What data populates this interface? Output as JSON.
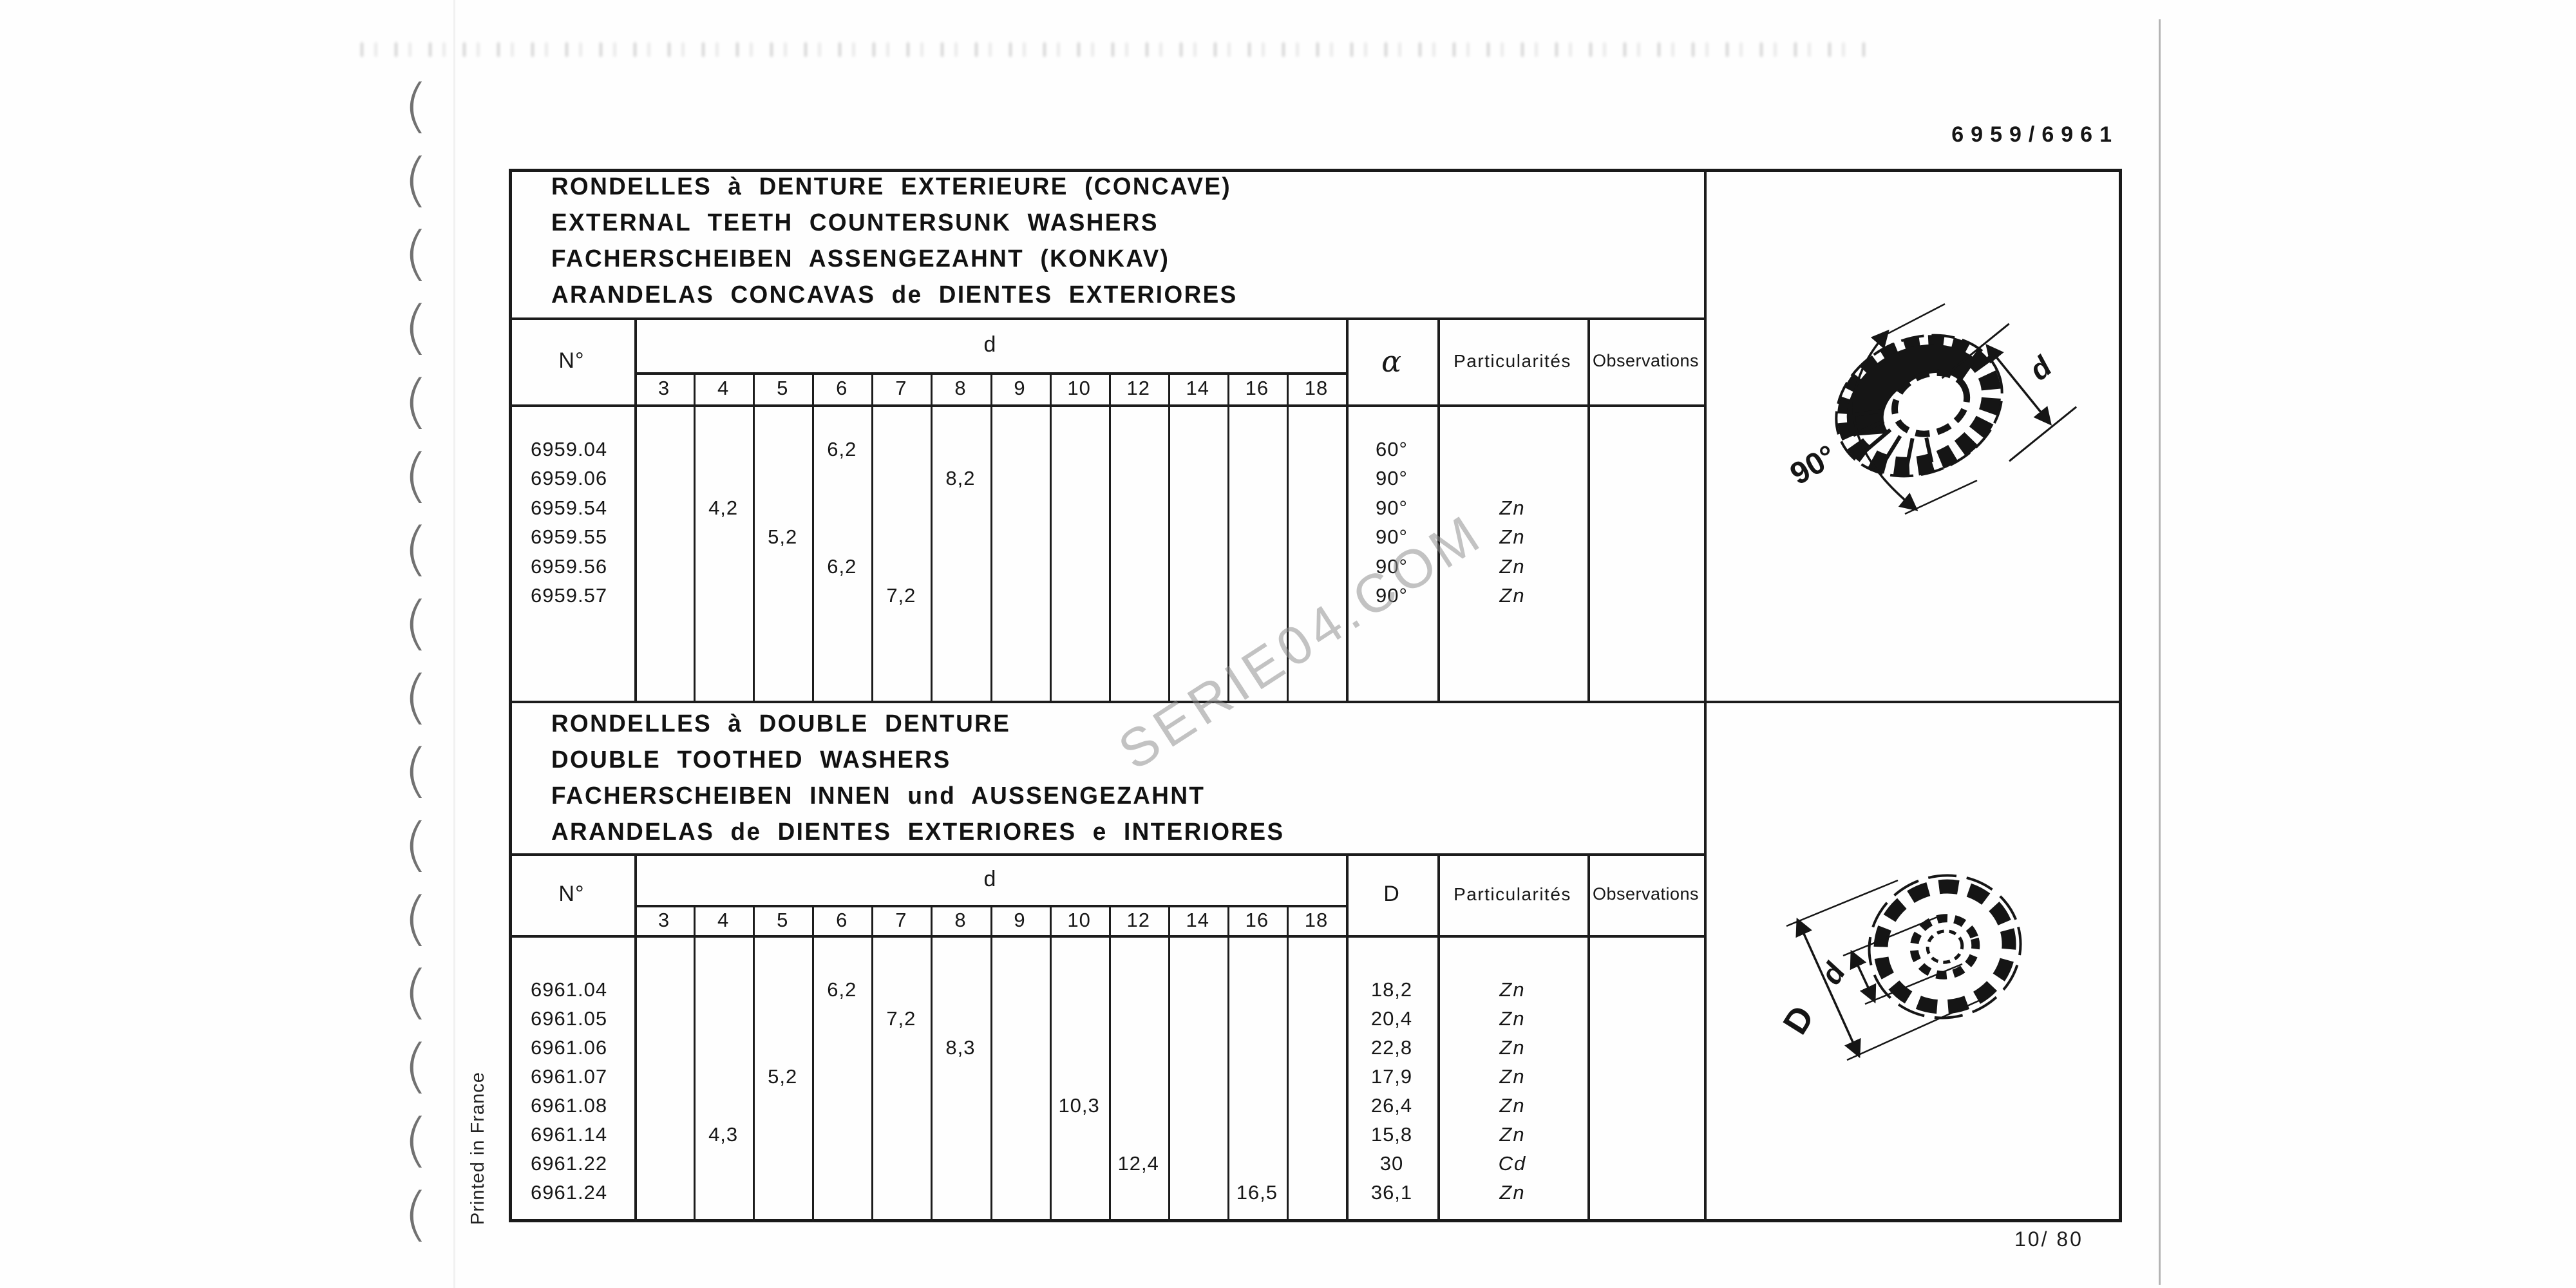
{
  "page": {
    "catalog_ref": "6959/6961",
    "page_number": "10/ 80",
    "printed_in": "Printed in France",
    "watermark": "SERIE04.COM"
  },
  "d_sizes": [
    "3",
    "4",
    "5",
    "6",
    "7",
    "8",
    "9",
    "10",
    "12",
    "14",
    "16",
    "18"
  ],
  "table1": {
    "titles": [
      "RONDELLES à DENTURE EXTERIEURE (CONCAVE)",
      "EXTERNAL TEETH COUNTERSUNK WASHERS",
      "FACHERSCHEIBEN ASSENGEZAHNT (KONKAV)",
      "ARANDELAS CONCAVAS de DIENTES EXTERIORES"
    ],
    "headers": {
      "no": "N°",
      "d": "d",
      "angle": "α",
      "part": "Particularités",
      "obs": "Observations"
    },
    "rows": [
      {
        "no": "6959.04",
        "d_col": "6",
        "d_val": "6,2",
        "angle": "60°",
        "part": ""
      },
      {
        "no": "6959.06",
        "d_col": "8",
        "d_val": "8,2",
        "angle": "90°",
        "part": ""
      },
      {
        "no": "6959.54",
        "d_col": "4",
        "d_val": "4,2",
        "angle": "90°",
        "part": "Zn"
      },
      {
        "no": "6959.55",
        "d_col": "5",
        "d_val": "5,2",
        "angle": "90°",
        "part": "Zn"
      },
      {
        "no": "6959.56",
        "d_col": "6",
        "d_val": "6,2",
        "angle": "90°",
        "part": "Zn"
      },
      {
        "no": "6959.57",
        "d_col": "7",
        "d_val": "7,2",
        "angle": "90°",
        "part": "Zn"
      }
    ]
  },
  "table2": {
    "titles": [
      "RONDELLES à DOUBLE DENTURE",
      "DOUBLE TOOTHED WASHERS",
      "FACHERSCHEIBEN INNEN und AUSSENGEZAHNT",
      "ARANDELAS de DIENTES EXTERIORES e INTERIORES"
    ],
    "headers": {
      "no": "N°",
      "d": "d",
      "D": "D",
      "part": "Particularités",
      "obs": "Observations"
    },
    "rows": [
      {
        "no": "6961.04",
        "d_col": "6",
        "d_val": "6,2",
        "D": "18,2",
        "part": "Zn"
      },
      {
        "no": "6961.05",
        "d_col": "7",
        "d_val": "7,2",
        "D": "20,4",
        "part": "Zn"
      },
      {
        "no": "6961.06",
        "d_col": "8",
        "d_val": "8,3",
        "D": "22,8",
        "part": "Zn"
      },
      {
        "no": "6961.07",
        "d_col": "5",
        "d_val": "5,2",
        "D": "17,9",
        "part": "Zn"
      },
      {
        "no": "6961.08",
        "d_col": "10",
        "d_val": "10,3",
        "D": "26,4",
        "part": "Zn"
      },
      {
        "no": "6961.14",
        "d_col": "4",
        "d_val": "4,3",
        "D": "15,8",
        "part": "Zn"
      },
      {
        "no": "6961.22",
        "d_col": "12",
        "d_val": "12,4",
        "D": "30",
        "part": "Cd"
      },
      {
        "no": "6961.24",
        "d_col": "16",
        "d_val": "16,5",
        "D": "36,1",
        "part": "Zn"
      }
    ]
  },
  "diagram1": {
    "angle_label": "90°",
    "d_label": "d"
  },
  "diagram2": {
    "D_label": "D",
    "d_label": "d"
  }
}
